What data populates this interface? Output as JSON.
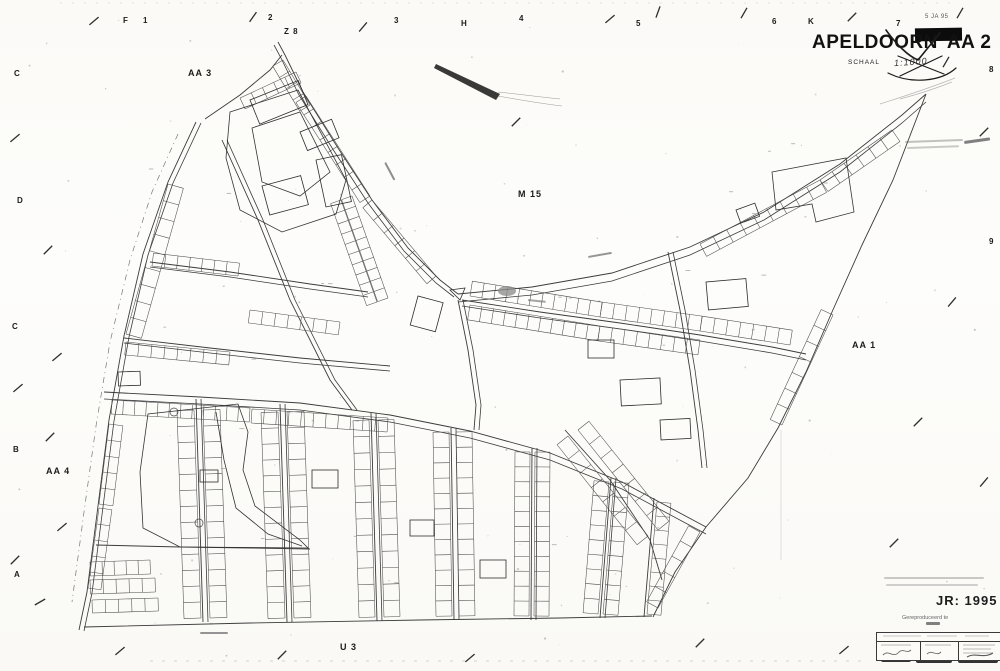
{
  "title_block": {
    "city": "APELDOORN",
    "sheet": "AA 2",
    "scale_label": "SCHAAL",
    "scale_value": "1:1000",
    "stamp_date": "5 JA 95"
  },
  "corner": {
    "year_label": "JR: 1995",
    "repro_label": "Gereproduceerd te"
  },
  "labels": [
    {
      "t": "F",
      "x": 123,
      "y": 17,
      "s": 8,
      "w": 700,
      "n": "grid-label-f"
    },
    {
      "t": "1",
      "x": 143,
      "y": 17,
      "s": 8,
      "w": 700,
      "n": "grid-label-1"
    },
    {
      "t": "2",
      "x": 268,
      "y": 14,
      "s": 8,
      "w": 700,
      "n": "grid-label-2"
    },
    {
      "t": "3",
      "x": 394,
      "y": 17,
      "s": 8,
      "w": 700,
      "n": "grid-label-3"
    },
    {
      "t": "H",
      "x": 461,
      "y": 20,
      "s": 8,
      "w": 700,
      "n": "grid-label-h"
    },
    {
      "t": "4",
      "x": 519,
      "y": 15,
      "s": 8,
      "w": 700,
      "n": "grid-label-4"
    },
    {
      "t": "5",
      "x": 636,
      "y": 20,
      "s": 8,
      "w": 700,
      "n": "grid-label-5"
    },
    {
      "t": "6",
      "x": 772,
      "y": 18,
      "s": 8,
      "w": 700,
      "n": "grid-label-6"
    },
    {
      "t": "K",
      "x": 808,
      "y": 18,
      "s": 8,
      "w": 700,
      "n": "grid-label-k"
    },
    {
      "t": "7",
      "x": 896,
      "y": 20,
      "s": 8,
      "w": 700,
      "n": "grid-label-7"
    },
    {
      "t": "8",
      "x": 989,
      "y": 66,
      "s": 8,
      "w": 700,
      "n": "grid-label-8"
    },
    {
      "t": "9",
      "x": 989,
      "y": 238,
      "s": 8,
      "w": 700,
      "n": "grid-label-9"
    },
    {
      "t": "C",
      "x": 14,
      "y": 70,
      "s": 8,
      "w": 700,
      "n": "grid-label-c1"
    },
    {
      "t": "D",
      "x": 17,
      "y": 197,
      "s": 8,
      "w": 700,
      "n": "grid-label-d"
    },
    {
      "t": "C",
      "x": 12,
      "y": 323,
      "s": 8,
      "w": 700,
      "n": "grid-label-c2"
    },
    {
      "t": "B",
      "x": 13,
      "y": 446,
      "s": 8,
      "w": 700,
      "n": "grid-label-b"
    },
    {
      "t": "A",
      "x": 14,
      "y": 571,
      "s": 8,
      "w": 700,
      "n": "grid-label-a"
    },
    {
      "t": "AA 3",
      "x": 188,
      "y": 69,
      "s": 9,
      "w": 700,
      "n": "sector-label-aa3"
    },
    {
      "t": "Z 8",
      "x": 284,
      "y": 28,
      "s": 8,
      "w": 700,
      "n": "sector-label-z8"
    },
    {
      "t": "M 15",
      "x": 518,
      "y": 190,
      "s": 9,
      "w": 700,
      "n": "sector-label-m15"
    },
    {
      "t": "AA 1",
      "x": 852,
      "y": 341,
      "s": 9,
      "w": 700,
      "n": "sector-label-aa1"
    },
    {
      "t": "AA 4",
      "x": 46,
      "y": 467,
      "s": 9,
      "w": 700,
      "n": "sector-label-aa4"
    },
    {
      "t": "U 3",
      "x": 340,
      "y": 643,
      "s": 9,
      "w": 700,
      "n": "sector-label-u3"
    }
  ],
  "map": {
    "roads": [
      {
        "p": [
          196,
          122,
          168,
          182,
          143,
          254,
          124,
          336,
          109,
          420,
          98,
          506,
          87,
          592,
          79,
          630
        ],
        "d": [
          5,
          1
        ]
      },
      {
        "p": [
          278,
          42,
          285,
          55,
          303,
          92,
          338,
          148,
          372,
          200,
          408,
          248,
          440,
          280,
          458,
          294
        ],
        "d": [
          -4,
          3
        ]
      },
      {
        "p": [
          205,
          119,
          240,
          95,
          270,
          70,
          282,
          55
        ]
      },
      {
        "p": [
          458,
          294,
          532,
          287,
          612,
          273,
          690,
          247,
          764,
          212,
          840,
          164,
          902,
          115,
          926,
          94
        ],
        "d": [
          0,
          8
        ]
      },
      {
        "p": [
          926,
          94,
          893,
          180,
          862,
          245,
          832,
          312,
          806,
          372,
          778,
          428,
          748,
          478,
          706,
          527
        ]
      },
      {
        "p": [
          706,
          527,
          675,
          572,
          653,
          617
        ]
      },
      {
        "p": [
          462,
          300,
          540,
          312,
          620,
          323,
          700,
          335,
          772,
          347,
          806,
          354
        ],
        "d": [
          0,
          6
        ]
      },
      {
        "p": [
          104,
          392,
          200,
          397,
          300,
          403,
          390,
          415,
          470,
          431,
          550,
          453,
          622,
          482,
          706,
          527
        ],
        "d": [
          0,
          7
        ]
      },
      {
        "p": [
          84,
          627,
          250,
          623,
          420,
          620,
          560,
          618,
          652,
          616
        ]
      },
      {
        "p": [
          196,
          399,
          203,
          622
        ],
        "d": [
          5,
          0
        ]
      },
      {
        "p": [
          280,
          404,
          287,
          622
        ],
        "d": [
          5,
          0
        ]
      },
      {
        "p": [
          371,
          413,
          377,
          621
        ],
        "d": [
          5,
          0
        ]
      },
      {
        "p": [
          451,
          428,
          454,
          620
        ],
        "d": [
          5,
          0
        ]
      },
      {
        "p": [
          532,
          448,
          531,
          620
        ],
        "d": [
          5,
          0
        ]
      },
      {
        "p": [
          611,
          478,
          600,
          618
        ],
        "d": [
          5,
          0
        ]
      },
      {
        "p": [
          654,
          498,
          644,
          617
        ]
      },
      {
        "p": [
          96,
          545,
          180,
          547,
          252,
          548,
          310,
          549
        ]
      },
      {
        "p": [
          150,
          262,
          230,
          272,
          310,
          284,
          368,
          292
        ],
        "d": [
          0,
          5
        ]
      },
      {
        "p": [
          124,
          338,
          210,
          348,
          300,
          358,
          390,
          366
        ],
        "d": [
          0,
          5
        ]
      },
      {
        "p": [
          222,
          140,
          258,
          220,
          290,
          300,
          330,
          380,
          352,
          410
        ],
        "d": [
          5,
          0
        ]
      },
      {
        "p": [
          668,
          252,
          680,
          310,
          690,
          370,
          698,
          430,
          702,
          468
        ],
        "d": [
          5,
          0
        ]
      },
      {
        "p": [
          458,
          300,
          468,
          350,
          476,
          405,
          474,
          430
        ],
        "d": [
          5,
          0
        ]
      },
      {
        "p": [
          565,
          430,
          610,
          480,
          650,
          540,
          662,
          580
        ]
      }
    ],
    "rows": [
      [
        168,
        184,
        126,
        334,
        9,
        -16
      ],
      [
        109,
        424,
        99,
        504,
        5,
        -14
      ],
      [
        99,
        508,
        88,
        588,
        5,
        -13
      ],
      [
        306,
        96,
        370,
        196,
        8,
        12
      ],
      [
        372,
        200,
        436,
        276,
        6,
        12
      ],
      [
        352,
        196,
        388,
        298,
        10,
        11
      ],
      [
        341,
        200,
        377,
        302,
        10,
        11
      ],
      [
        240,
        98,
        296,
        72,
        5,
        12
      ],
      [
        283,
        60,
        310,
        105,
        4,
        12
      ],
      [
        112,
        400,
        250,
        408,
        12,
        14
      ],
      [
        252,
        409,
        388,
        418,
        11,
        14
      ],
      [
        194,
        410,
        201,
        618,
        13,
        17
      ],
      [
        203,
        410,
        210,
        618,
        13,
        -17
      ],
      [
        278,
        412,
        285,
        618,
        13,
        17
      ],
      [
        287,
        412,
        294,
        618,
        13,
        -17
      ],
      [
        369,
        420,
        375,
        617,
        12,
        16
      ],
      [
        378,
        420,
        384,
        617,
        12,
        -16
      ],
      [
        449,
        432,
        452,
        616,
        12,
        16
      ],
      [
        456,
        432,
        459,
        616,
        12,
        -16
      ],
      [
        530,
        452,
        529,
        616,
        11,
        15
      ],
      [
        535,
        452,
        534,
        616,
        11,
        -15
      ],
      [
        609,
        482,
        598,
        614,
        9,
        15
      ],
      [
        614,
        482,
        603,
        614,
        9,
        -15
      ],
      [
        657,
        502,
        647,
        614,
        8,
        -14
      ],
      [
        470,
        296,
        600,
        317,
        11,
        -15
      ],
      [
        600,
        317,
        700,
        331,
        8,
        -15
      ],
      [
        700,
        331,
        790,
        345,
        7,
        -15
      ],
      [
        470,
        305,
        600,
        326,
        11,
        15
      ],
      [
        600,
        326,
        700,
        340,
        8,
        15
      ],
      [
        700,
        244,
        820,
        180,
        9,
        14
      ],
      [
        820,
        180,
        892,
        130,
        6,
        14
      ],
      [
        833,
        315,
        782,
        425,
        7,
        13
      ],
      [
        90,
        562,
        150,
        560,
        5,
        14
      ],
      [
        90,
        580,
        155,
        578,
        5,
        14
      ],
      [
        92,
        600,
        158,
        598,
        5,
        13
      ],
      [
        152,
        266,
        238,
        276,
        7,
        -13
      ],
      [
        126,
        342,
        230,
        352,
        8,
        13
      ],
      [
        250,
        310,
        340,
        322,
        7,
        13
      ],
      [
        568,
        436,
        648,
        536,
        7,
        14
      ],
      [
        578,
        430,
        658,
        530,
        7,
        -14
      ],
      [
        700,
        532,
        658,
        608,
        5,
        13
      ]
    ],
    "polys": [
      {
        "p": [
          230,
          112,
          298,
          90,
          346,
          180,
          336,
          214,
          282,
          232,
          240,
          210,
          226,
          158
        ],
        "close": true
      },
      {
        "p": [
          252,
          128,
          300,
          112,
          330,
          172,
          300,
          196,
          262,
          182
        ],
        "close": true
      },
      {
        "p": [
          140,
          472,
          148,
          414,
          238,
          404,
          248,
          432,
          243,
          470,
          255,
          506,
          300,
          540,
          308,
          548,
          180,
          547,
          143,
          528
        ],
        "close": true
      },
      {
        "p": [
          216,
          412,
          224,
          460,
          236,
          508,
          268,
          534,
          302,
          546
        ],
        "close": false
      },
      {
        "p": [
          772,
          172,
          846,
          158,
          854,
          212,
          816,
          222,
          812,
          204,
          776,
          210
        ],
        "close": true
      },
      {
        "p": [
          450,
          290,
          465,
          288,
          460,
          300
        ],
        "close": true
      }
    ],
    "rects": [
      [
        250,
        100,
        52,
        26,
        -22
      ],
      [
        300,
        132,
        34,
        20,
        -22
      ],
      [
        316,
        160,
        26,
        48,
        -12
      ],
      [
        262,
        186,
        40,
        30,
        -15
      ],
      [
        736,
        210,
        20,
        14,
        -20
      ],
      [
        706,
        282,
        40,
        28,
        -5
      ],
      [
        588,
        340,
        26,
        18,
        0
      ],
      [
        620,
        380,
        40,
        26,
        -3
      ],
      [
        660,
        420,
        30,
        20,
        -3
      ],
      [
        312,
        470,
        26,
        18,
        0
      ],
      [
        410,
        520,
        24,
        16,
        0
      ],
      [
        480,
        560,
        26,
        18,
        0
      ],
      [
        200,
        470,
        18,
        12,
        0
      ],
      [
        118,
        372,
        22,
        14,
        -2
      ],
      [
        418,
        296,
        26,
        30,
        15
      ]
    ],
    "circles": [
      [
        174,
        412,
        4
      ],
      [
        199,
        523,
        4
      ]
    ],
    "blobs": [
      [
        507,
        291,
        9,
        5
      ]
    ],
    "dashline": [
      178,
      134,
      152,
      192,
      130,
      260,
      110,
      342,
      96,
      426,
      84,
      512,
      72,
      602
    ],
    "ticks": [
      [
        94,
        21,
        -40
      ],
      [
        253,
        17,
        -55
      ],
      [
        363,
        27,
        -50
      ],
      [
        610,
        19,
        -40
      ],
      [
        658,
        12,
        -70
      ],
      [
        744,
        13,
        -60
      ],
      [
        852,
        17,
        -45
      ],
      [
        960,
        13,
        -60
      ],
      [
        516,
        122,
        -45
      ],
      [
        15,
        138,
        -40
      ],
      [
        48,
        250,
        -45
      ],
      [
        57,
        357,
        -40
      ],
      [
        18,
        388,
        -40
      ],
      [
        50,
        437,
        -45
      ],
      [
        62,
        527,
        -40
      ],
      [
        15,
        560,
        -45
      ],
      [
        40,
        602,
        -30
      ],
      [
        946,
        62,
        -60
      ],
      [
        984,
        132,
        -45
      ],
      [
        952,
        302,
        -50
      ],
      [
        918,
        422,
        -45
      ],
      [
        984,
        482,
        -50
      ],
      [
        894,
        543,
        -45
      ],
      [
        120,
        651,
        -40
      ],
      [
        282,
        655,
        -45
      ],
      [
        470,
        658,
        -40
      ],
      [
        700,
        643,
        -45
      ],
      [
        844,
        650,
        -40
      ]
    ],
    "smudges": [
      [
        386,
        162,
        20,
        62,
        0.75,
        2
      ],
      [
        588,
        256,
        24,
        -10,
        0.7,
        2
      ],
      [
        528,
        299,
        18,
        6,
        0.6,
        2
      ],
      [
        200,
        632,
        28,
        0,
        0.7,
        2
      ],
      [
        905,
        141,
        58,
        -2,
        0.4,
        2
      ],
      [
        907,
        147,
        52,
        -2,
        0.35,
        2
      ],
      [
        884,
        577,
        100,
        0,
        0.35,
        2
      ],
      [
        886,
        584,
        92,
        0,
        0.3,
        2
      ],
      [
        926,
        622,
        14,
        0,
        0.85,
        3
      ],
      [
        964,
        141,
        26,
        -8,
        0.85,
        3
      ]
    ],
    "streak": [
      436,
      64,
      500,
      94,
      496,
      100,
      434,
      68
    ],
    "fold_line": [
      781,
      430,
      781,
      560
    ]
  }
}
